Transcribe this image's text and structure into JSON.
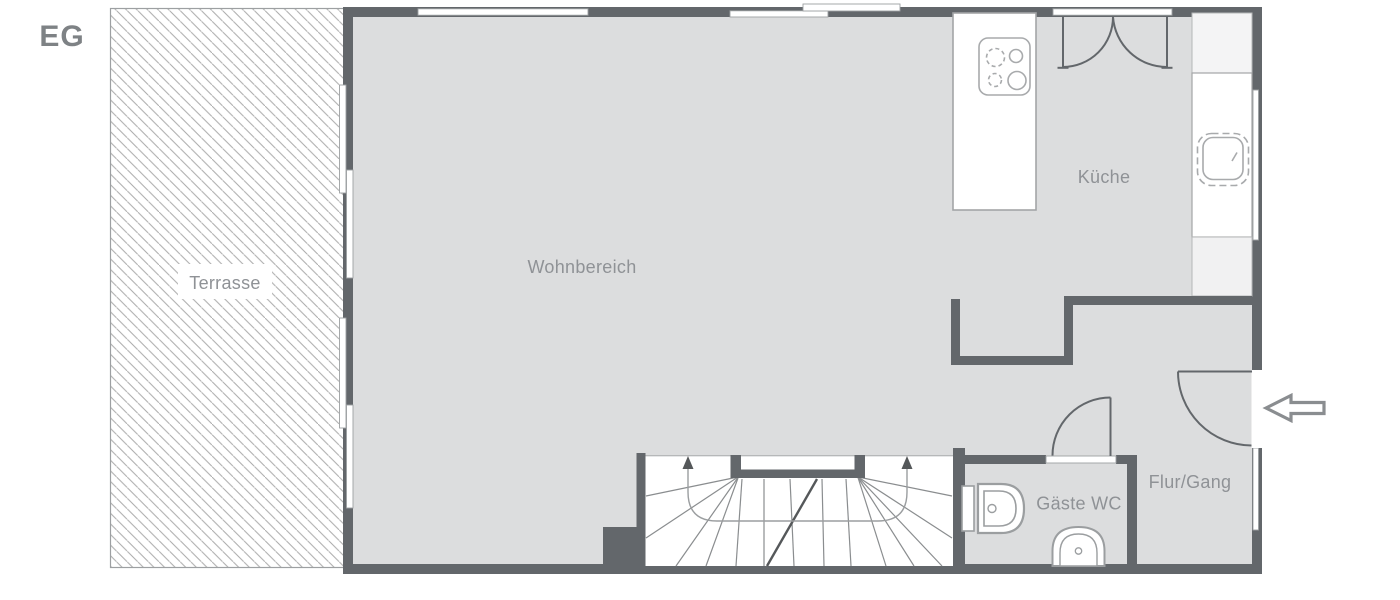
{
  "plan": {
    "floor_label": "EG",
    "rooms": {
      "terrasse": {
        "label": "Terrasse"
      },
      "wohnbereich": {
        "label": "Wohnbereich"
      },
      "kueche": {
        "label": "Küche"
      },
      "gaeste_wc": {
        "label": "Gäste WC"
      },
      "flur_gang": {
        "label": "Flur/Gang"
      }
    },
    "icons": [
      "stove-icon",
      "kitchen-sink-icon",
      "double-door-icon",
      "interior-door-icon",
      "entrance-door-icon",
      "entrance-arrow-icon",
      "stairs-icon",
      "toilet-icon",
      "washbasin-icon",
      "window-icon",
      "terrace-hatch-icon"
    ],
    "colors": {
      "wall": "#63676b",
      "floor": "#dcddde",
      "terrace_hatch": "#ababab",
      "fixture_stroke": "#9b9ea0",
      "label_text": "#8f9296",
      "floor_label_text": "#7e8285",
      "stair_accent": "#55585a",
      "white": "#ffffff"
    }
  }
}
